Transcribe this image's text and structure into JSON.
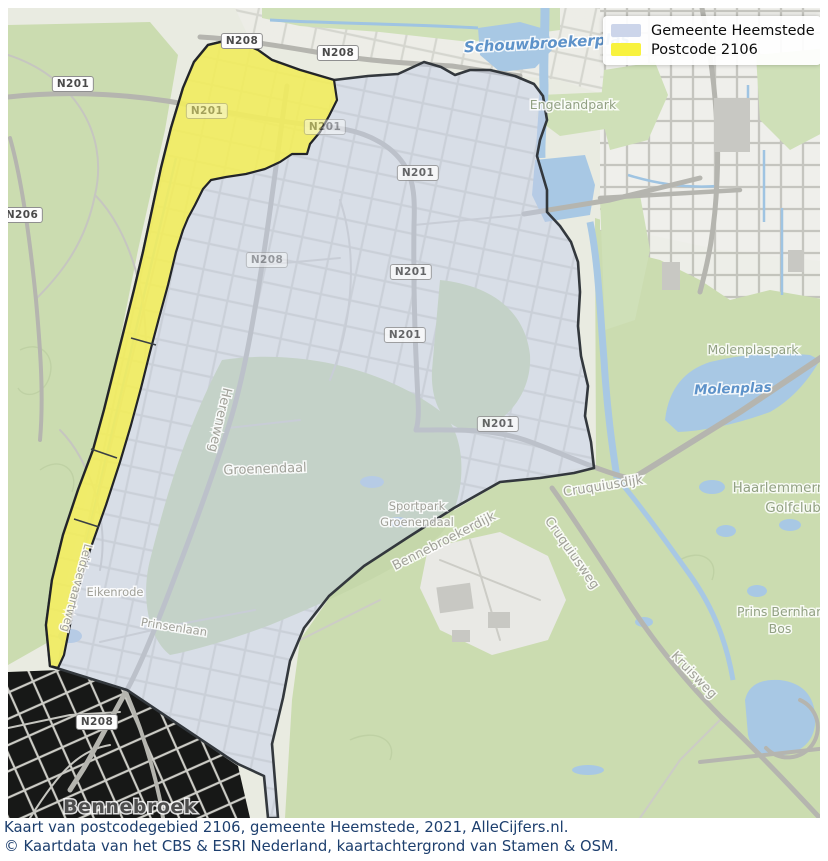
{
  "colors": {
    "postcode_yellow": "#f5ee55",
    "gemeente_fill": "#c3cde6",
    "boundary": "#33383d",
    "water": "#a8c8e4",
    "water_label": "#5d92c9",
    "park_label": "#92a183",
    "road_label": "#a1a199",
    "legend_blue": "#ccd5ea",
    "legend_yellow": "#f8f23e",
    "caption_text": "#1d3f6e"
  },
  "legend": {
    "items": [
      {
        "label": "Gemeente Heemstede",
        "swatch": "#ccd5ea"
      },
      {
        "label": "Postcode 2106",
        "swatch": "#f8f23e"
      }
    ]
  },
  "shields": [
    {
      "label": "N201"
    },
    {
      "label": "N208"
    },
    {
      "label": "N208"
    },
    {
      "label": "N206"
    },
    {
      "label": "N208"
    },
    {
      "label": "N201"
    },
    {
      "label": "N201"
    },
    {
      "label": "N208"
    },
    {
      "label": "N201"
    },
    {
      "label": "N201"
    },
    {
      "label": "N201"
    },
    {
      "label": "N201"
    }
  ],
  "labels": {
    "schouwbroekerplas": {
      "text": "Schouwbroekerplas"
    },
    "molenplas": {
      "text": "Molenplas"
    },
    "engelandpark": {
      "text": "Engelandpark"
    },
    "molenplaspark": {
      "text": "Molenplaspark"
    },
    "haarlemmermeerse": {
      "text": "Haarlemmermeerse"
    },
    "golfclub": {
      "text": "Golfclub"
    },
    "prins_bernhard": {
      "text": "Prins Bernhard"
    },
    "bos": {
      "text": "Bos"
    },
    "herenweg": {
      "text": "Herenweg"
    },
    "groenendaal": {
      "text": "Groenendaal"
    },
    "sportpark_line1": {
      "text": "Sportpark"
    },
    "sportpark_line2": {
      "text": "Groenendaal"
    },
    "bennebroekerdijk": {
      "text": "Bennebroekerdijk"
    },
    "cruquiusdijk": {
      "text": "Cruquiusdijk"
    },
    "cruquiusweg": {
      "text": "Cruquiusweg"
    },
    "kruisweg": {
      "text": "Kruisweg"
    },
    "eikenrode": {
      "text": "Eikenrode"
    },
    "prinsenlaan": {
      "text": "Prinsenlaan"
    },
    "leidsevaartweg": {
      "text": "Leidsevaartweg"
    },
    "bennebroek": {
      "text": "Bennebroek"
    }
  },
  "caption": {
    "line1": "Kaart van postcodegebied 2106, gemeente Heemstede, 2021, AlleCijfers.nl.",
    "line2": "© Kaartdata van het CBS & ESRI Nederland, kaartachtergrond van Stamen & OSM."
  }
}
